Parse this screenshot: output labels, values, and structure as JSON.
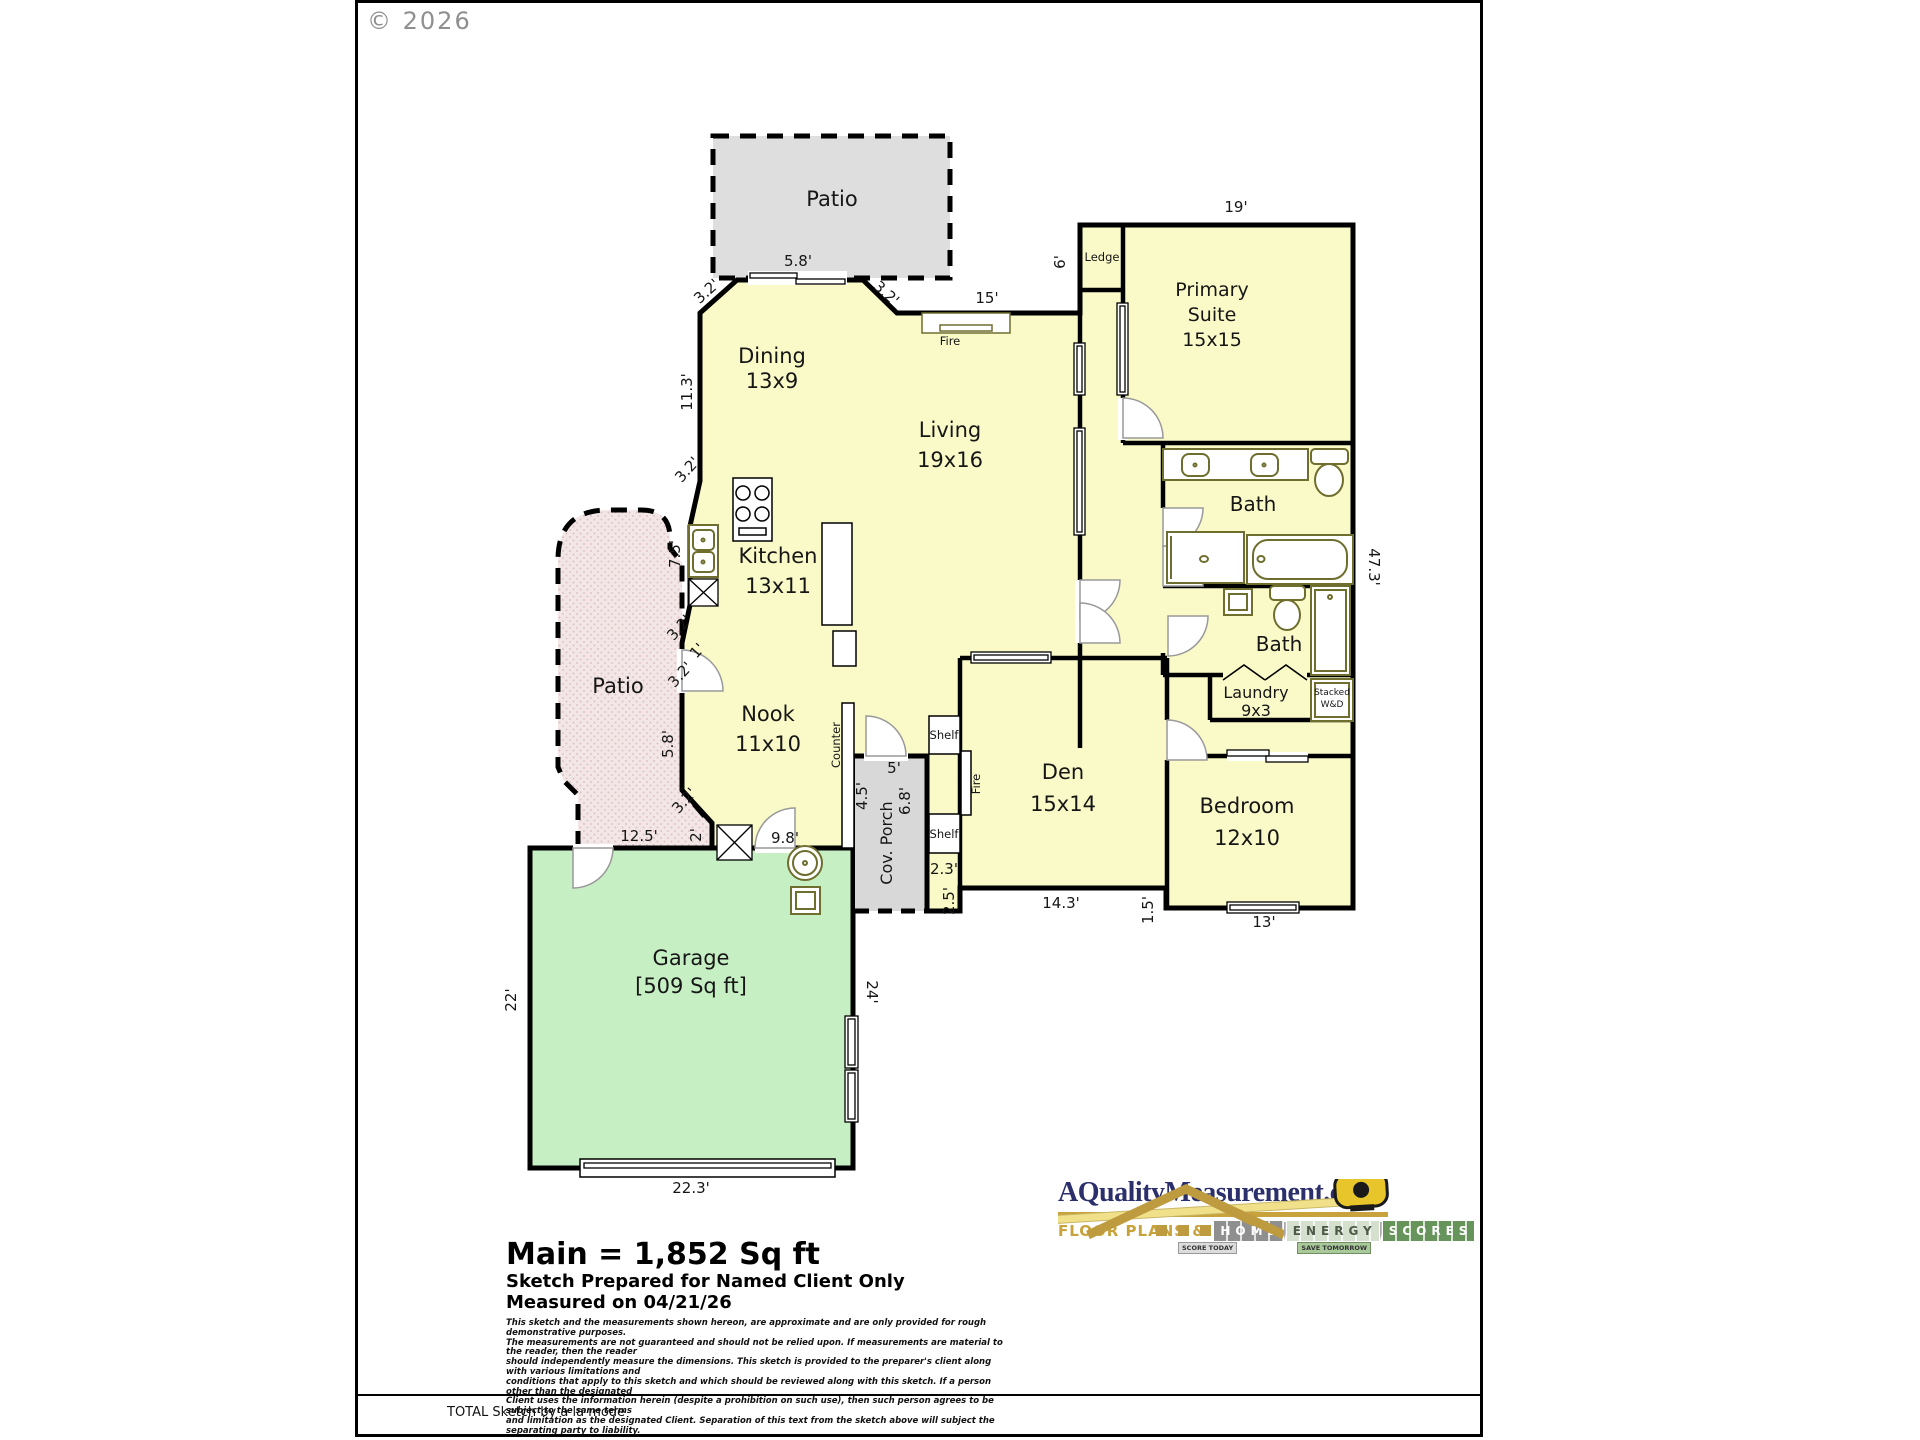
{
  "page": {
    "copyright": "© 2026",
    "bottom_note": "TOTAL Sketch by a la mode"
  },
  "summary": {
    "main_area": "Main = 1,852 Sq ft",
    "prepared_for": "Sketch Prepared for Named Client Only",
    "measured_on": "Measured on 04/21/26",
    "disclaimer": [
      "This sketch and the measurements shown hereon, are approximate and are only provided for rough demonstrative purposes.",
      "The measurements are not guaranteed and should not be relied upon.  If measurements are material to the reader, then the reader",
      "should independently measure the dimensions.  This sketch is provided to the preparer's client along with various limitations and",
      "conditions that apply to this sketch and which should be reviewed along with this sketch.  If a person other than the designated",
      "Client uses the information herein (despite a prohibition on such use), then such person agrees to be subject to the same terms",
      "and limitation as the designated Client.  Separation of this text from the sketch above will subject the separating party to liability."
    ]
  },
  "logo": {
    "site": "AQualityMeasurement.com",
    "tagline": "FLOOR PLANS &",
    "word1": "HOME",
    "word2": "ENERGY",
    "word3": "SCORES",
    "badge1": "SCORE TODAY",
    "badge2": "SAVE TOMORROW"
  },
  "rooms": {
    "patio_top": "Patio",
    "patio_left": "Patio",
    "dining": {
      "name": "Dining",
      "size": "13x9"
    },
    "living": {
      "name": "Living",
      "size": "19x16"
    },
    "kitchen": {
      "name": "Kitchen",
      "size": "13x11"
    },
    "nook": {
      "name": "Nook",
      "size": "11x10"
    },
    "primary_suite": {
      "line1": "Primary",
      "line2": "Suite",
      "size": "15x15"
    },
    "bath_primary": "Bath",
    "bath_hall": "Bath",
    "laundry": {
      "name": "Laundry",
      "size": "9x3"
    },
    "den": {
      "name": "Den",
      "size": "15x14"
    },
    "bedroom": {
      "name": "Bedroom",
      "size": "12x10"
    },
    "garage": {
      "name": "Garage",
      "size": "[509 Sq ft]"
    },
    "porch": "Cov. Porch"
  },
  "features": {
    "ledge": "Ledge",
    "fire_living": "Fire",
    "fire_den": "Fire",
    "counter": "Counter",
    "shelf_upper": "Shelf",
    "shelf_lower": "Shelf",
    "stacked_line1": "Stacked",
    "stacked_line2": "W&D"
  },
  "dims": {
    "patio_door": "5.8'",
    "dining_chamfer_left": "3.2'",
    "dining_chamfer_right": "3.2'",
    "living_north": "15'",
    "suite_north": "19'",
    "ledge_west": "6'",
    "dining_west": "11.3'",
    "kitchen_chamfer_top": "3.2'",
    "kitchen_west": "7.5'",
    "kitchen_chamfer_a": "3.2'",
    "kitchen_jog": "1'",
    "kitchen_chamfer_b": "3.2'",
    "nook_west": "5.8'",
    "nook_chamfer": "3.2'",
    "nook_jog": "2'",
    "patio_south": "12.5'",
    "garage_north_seg": "9.8'",
    "garage_west": "22'",
    "garage_south": "22.3'",
    "garage_east": "24'",
    "porch_width": "5'",
    "porch_west": "4.5'",
    "porch_east": "6.8'",
    "entry_jog_w": "2.3'",
    "entry_jog_h": "2.5'",
    "den_south": "14.3'",
    "step": "1.5'",
    "bedroom_south": "13'",
    "east_wall": "47.3'"
  },
  "colors": {
    "room_fill": "#FAFAC8",
    "patio_top_fill": "#DEDEDE",
    "patio_left_fill": "#F3E6E6",
    "garage_fill": "#C7EFC4",
    "porch_fill": "#D8D8D8",
    "wall": "#000000",
    "fixture": "#6E6E2E",
    "logo_navy": "#2B2F6B",
    "logo_gold": "#C8A33C"
  }
}
